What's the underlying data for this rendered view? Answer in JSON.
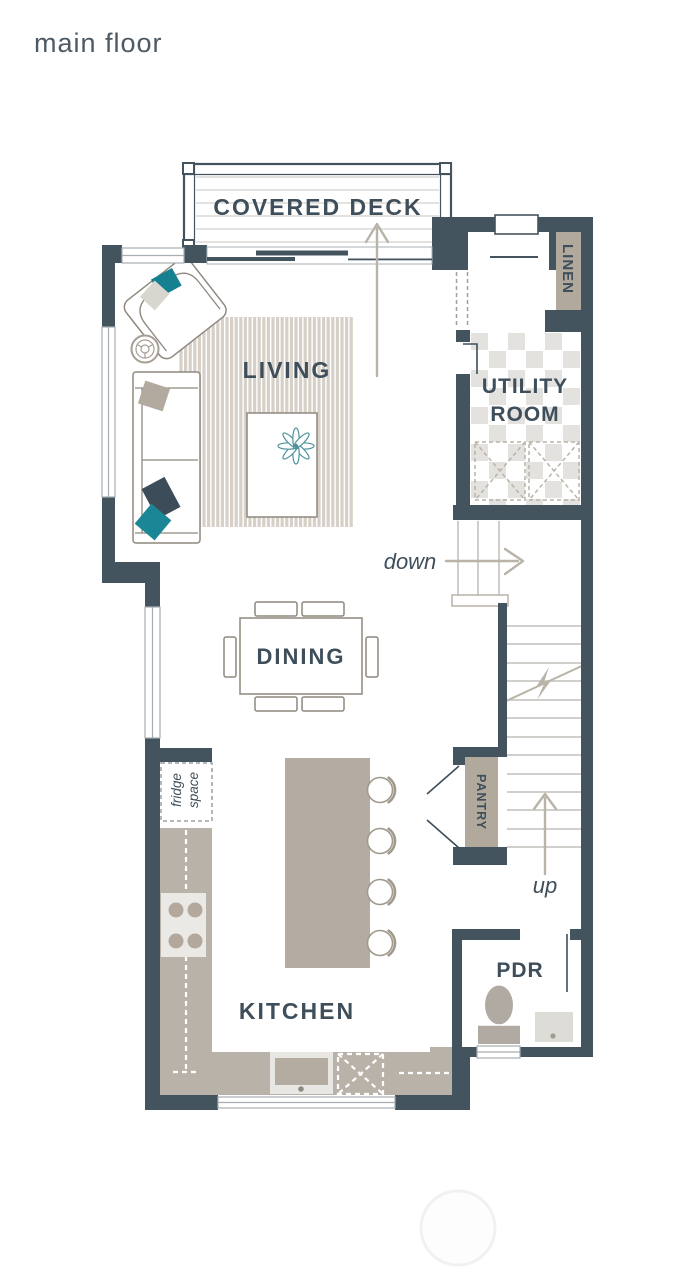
{
  "title": "main floor",
  "rooms": {
    "covered_deck": "COVERED DECK",
    "living": "LIVING",
    "dining": "DINING",
    "kitchen": "KITCHEN",
    "utility_line1": "UTILITY",
    "utility_line2": "ROOM",
    "linen": "LINEN",
    "pantry": "PANTRY",
    "powder_room": "PDR"
  },
  "annotations": {
    "stairs_down": "down",
    "stairs_up": "up",
    "fridge_line1": "fridge",
    "fridge_line2": "space"
  },
  "colors": {
    "wall": "#44545f",
    "label_text": "#3e4e5a",
    "furniture_taupe": "#b4aca2",
    "counter_taupe": "#b9b2a9",
    "rug_taupe": "#d6d0c8",
    "shelf_beige": "#b2a99d",
    "tile_grey": "#e4e2de",
    "outline_grey": "#8e887f",
    "stair_tread_grey": "#cac8c4",
    "arrow_grey": "#b9b3a8",
    "accent_teal": "#1b8496"
  }
}
